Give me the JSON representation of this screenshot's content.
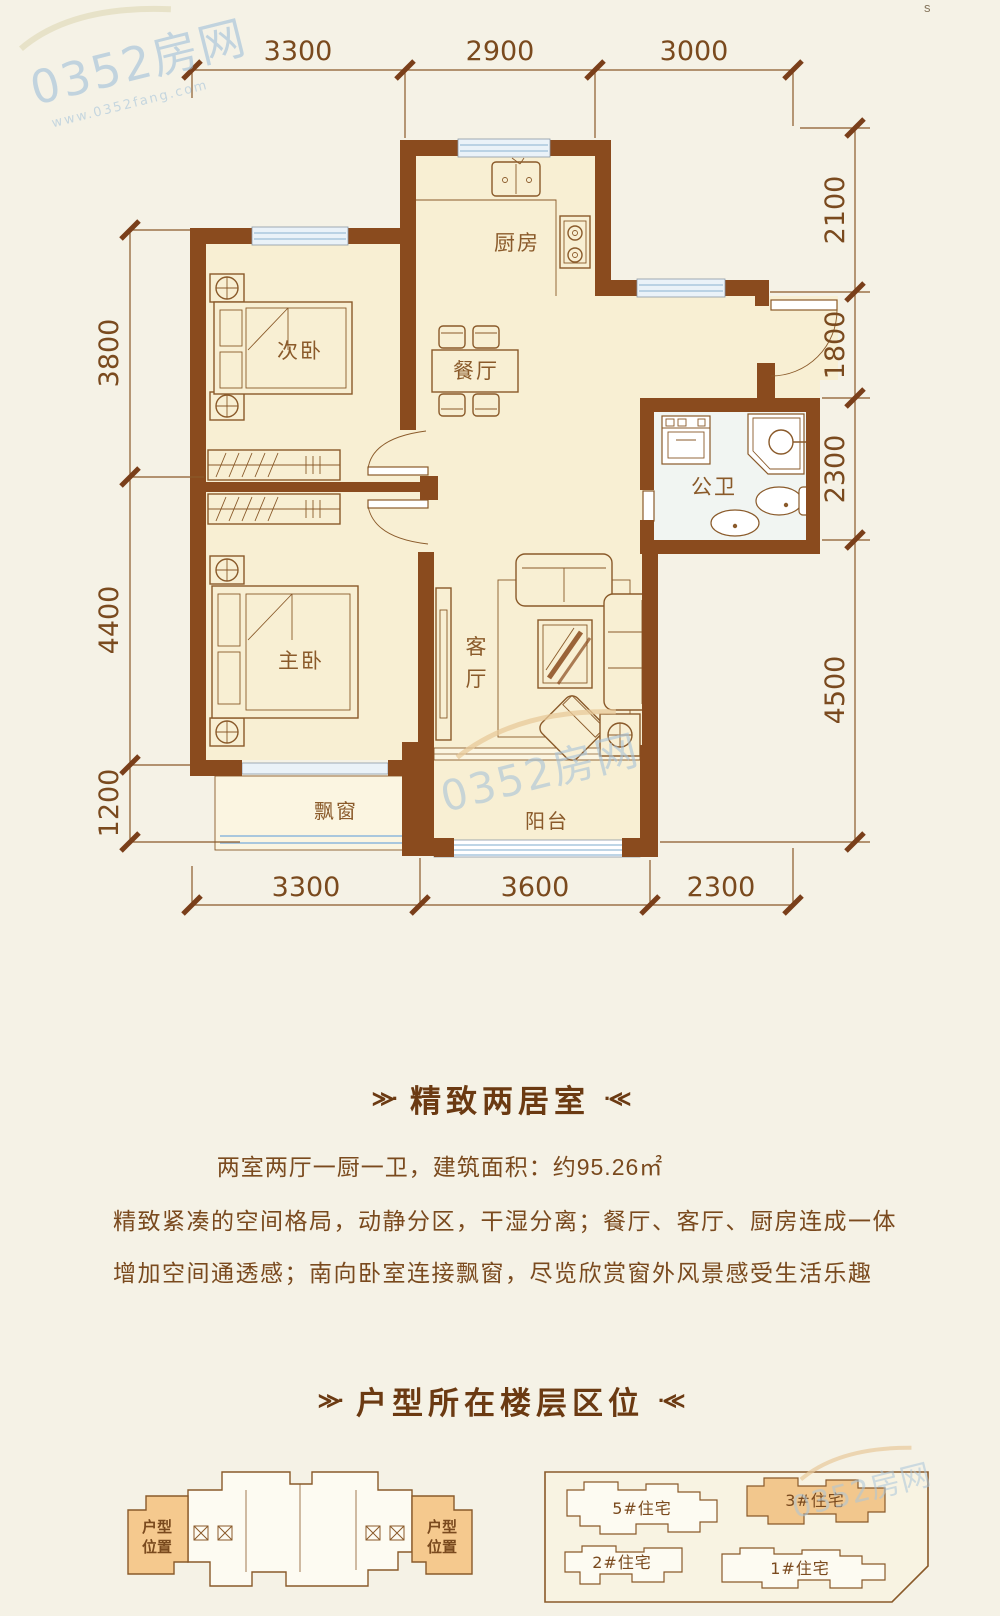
{
  "page": {
    "corner_mark": "s"
  },
  "watermark": {
    "brand": "0352房网",
    "url": "www.0352fang.com"
  },
  "ornaments": {
    "left": "≫·",
    "right": "·≪"
  },
  "floorplan": {
    "rooms": {
      "kitchen": "厨房",
      "second_bedroom": "次卧",
      "dining": "餐厅",
      "bathroom": "公卫",
      "master_bedroom": "主卧",
      "living_top": "客",
      "living_bottom": "厅",
      "bay_window": "飘窗",
      "balcony": "阳台"
    },
    "dimensions": {
      "top": [
        "3300",
        "2900",
        "3000"
      ],
      "bottom": [
        "3300",
        "3600",
        "2300"
      ],
      "left": [
        "3800",
        "4400",
        "1200"
      ],
      "right": [
        "2100",
        "1800",
        "2300",
        "4500"
      ]
    }
  },
  "sections": {
    "title1": "精致两居室",
    "specs": "两室两厅一厨一卫，建筑面积：约95.26㎡",
    "desc1": "精致紧凑的空间格局，动静分区，干湿分离；餐厅、客厅、厨房连成一体",
    "desc2": "增加空间通透感；南向卧室连接飘窗，尽览欣赏窗外风景感受生活乐趣",
    "title2": "户型所在楼层区位"
  },
  "location": {
    "unit_line1": "户型",
    "unit_line2": "位置",
    "buildings": [
      {
        "label": "5#住宅",
        "highlighted": false
      },
      {
        "label": "3#住宅",
        "highlighted": true
      },
      {
        "label": "2#住宅",
        "highlighted": false
      },
      {
        "label": "1#住宅",
        "highlighted": false
      }
    ]
  },
  "colors": {
    "wall": "#8a4b1e",
    "room_fill": "#f8efd3",
    "highlight": "#f2c78d",
    "text_brown": "#7a4a1e",
    "watermark_blue": "#9fc0da"
  }
}
